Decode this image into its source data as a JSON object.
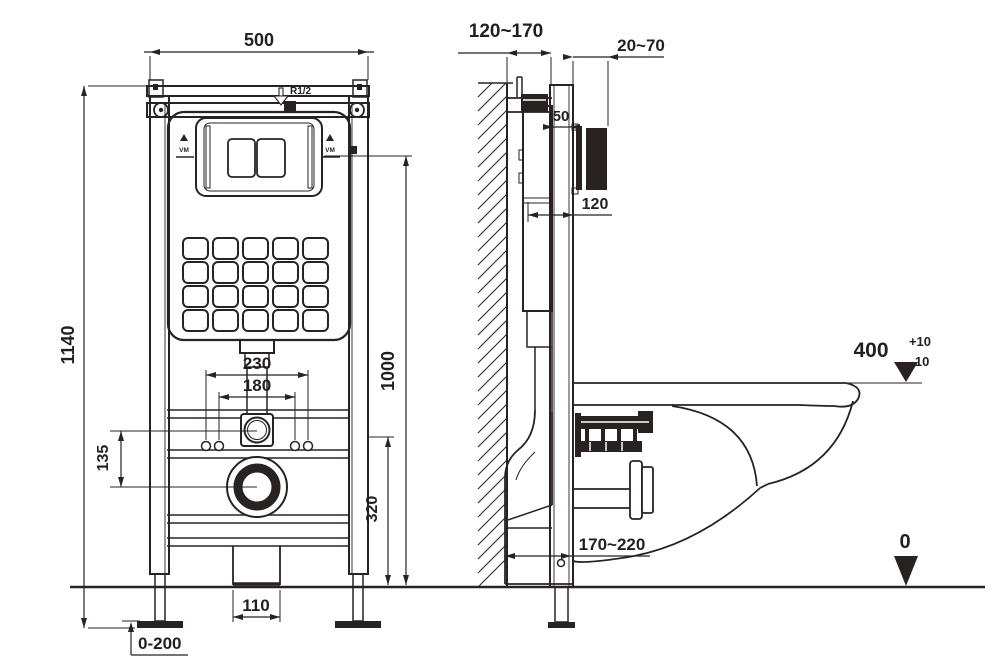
{
  "title": "Wall-hung toilet concealed cistern frame installation drawing",
  "colors": {
    "line": "#282223",
    "background": "#ffffff"
  },
  "front_view": {
    "frame_width": "500",
    "frame_height": "1140",
    "fixing_spacing_outer": "230",
    "fixing_spacing_inner": "180",
    "inlet_to_outlet_drop": "135",
    "actuator_height": "1000",
    "outlet_height": "320",
    "floor_outlet_width": "110",
    "leg_adjustment": "0-200",
    "water_inlet_thread": "R1/2",
    "level_marker": "VM"
  },
  "side_view": {
    "wall_to_front_depth": "120~170",
    "finished_wall_range": "20~70",
    "rail_depth": "50",
    "tank_depth": "120",
    "floor_outlet_offset": "170~220",
    "rim_height_value": "400",
    "rim_height_tol_plus": "+10",
    "rim_height_tol_minus": "-10",
    "floor_datum": "0"
  }
}
